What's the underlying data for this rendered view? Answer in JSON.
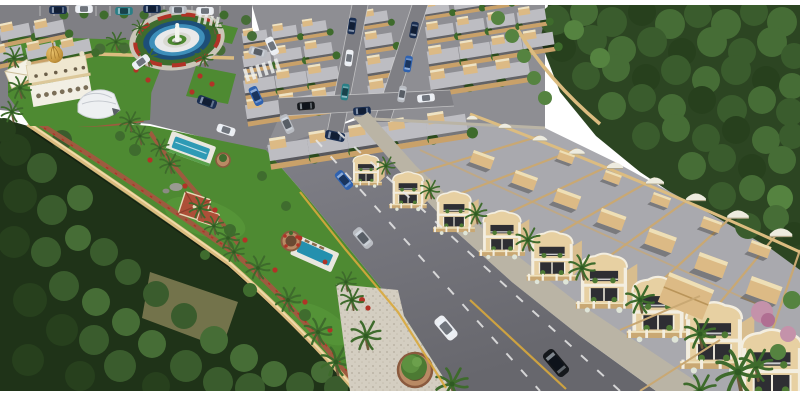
{
  "image": {
    "domain": "natural-image",
    "description": "Aerial 3D architectural rendering of a gated residential township: dense rows of flat-roof villas, a row of two-storey arched townhouses along a main boulevard, a landscaped central park with swimming pools and a red-roof gazebo, a fountain roundabout, a white clubhouse with a golden dome, a white event canopy, palm-lined sidewalks, cars on the roads, and dense forest framing the top-right and bottom-left.",
    "frame": {
      "background": "#ffffff",
      "top_margin_px": 5,
      "bottom_margin_px": 9
    }
  },
  "palette": {
    "white": "#ffffff",
    "plazaRoad": "#7f7f84",
    "asphaltTop": "#808088",
    "asphaltBot": "#66666d",
    "gridBase": "#8e8e93",
    "gridRoof": "#bdbdc2",
    "gridTan": "#dcba85",
    "gridWall": "#c9a169",
    "lawn": "#4e8a32",
    "lawnLight": "#5fa03e",
    "forest": "#2c4522",
    "forestDark": "#1f3318",
    "crown1": "#3a5c2d",
    "crown2": "#466d36",
    "crown3": "#27401d",
    "crownLight": "#558340",
    "clearing": "#7b7850",
    "paver": "#d4cec1",
    "sidewalk": "#bab4a5",
    "wallTan": "#dcbc80",
    "wallLight": "#f0dcab",
    "brick": "#9d5b3f",
    "flowerRed": "#b13327",
    "hedge": "#3f6c2e",
    "blueOuter": "#1d4f78",
    "blueInner": "#3e8fba",
    "ringWhite": "#e9e9ea",
    "padGray": "#d9d9d2",
    "statue": "#f4f4ee",
    "gold": "#c6973f",
    "mosqueWhite": "#f2efe4",
    "mosqueCream": "#efe7cf",
    "mosqueTrim": "#dcc89a",
    "gazeboRoof": "#ad4f38",
    "poolDeck": "#e9e7df",
    "poolWater": "#2e9ab5",
    "poolWater2": "#2490ae",
    "thFacade": "#e7d0a2",
    "thTrim": "#f3eee0",
    "thDark": "#2e2e33",
    "thRoof": "#a9a9ae",
    "thParapet": "#c9a873",
    "thSide": "#d8bd8e",
    "capWhite": "#edebdf",
    "palmGreen": "#3e6b2c",
    "palmTrunk": "#6e5a3a",
    "pinkTree": "#c492aa",
    "yellowLine": "#d8a93c",
    "carNavy": "#1b2f52",
    "carBlue": "#2f62b0",
    "carSilver": "#b9bcc2",
    "carWhite": "#eceef2",
    "carBlack": "#15181c",
    "carTeal": "#2a7f86"
  },
  "scene": {
    "regions": [
      {
        "name": "entry-plaza",
        "description": "asphalt entry plaza with fountain roundabout, white parking ticks, parked cars, zebra crosswalk"
      },
      {
        "name": "fountain-roundabout",
        "rings": [
          "red flower hedge ring",
          "dark blue water ring",
          "light blue water ring",
          "white walkway ring",
          "central lawn pad with white statue"
        ],
        "palms": 4
      },
      {
        "name": "mosque-clubhouse",
        "features": [
          "white arched two-storey facade",
          "golden onion dome with finial",
          "gabled side wing"
        ]
      },
      {
        "name": "event-canopy",
        "description": "white curved fabric canopy on the clubhouse lawn"
      },
      {
        "name": "villa-grid",
        "rows": 5,
        "approx_units": 37,
        "unit_style": "flat grey roof slab, tan rooftop room, beige front wall, street tree between units",
        "internal_streets": 3
      },
      {
        "name": "townhouse-row",
        "units": 10,
        "style": "two-storey cream facades with curved white-trimmed parapets, dark recessed balconies with shrubs, tan boundary fences, grey roofs with tan parapet walls, tan stair boxes and white arched roof caps at the rear"
      },
      {
        "name": "main-road",
        "lanes": 3,
        "markings": [
          "white dashed lane lines",
          "yellow edge lines"
        ],
        "vehicles_driving": 4
      },
      {
        "name": "central-park",
        "features": [
          "curved tan boundary wall",
          "brick walking paths lined with red flowers",
          "two blue swimming pools with white decks",
          "red-roof gazebo and hut",
          "round stone flower planter",
          "grey rocks",
          "palm trees",
          "lawn"
        ]
      },
      {
        "name": "paver-plaza",
        "features": [
          "light stone paving",
          "circular brick tree planter",
          "palm trees"
        ]
      },
      {
        "name": "forest",
        "coverage": [
          "top-right block",
          "bottom-left block with olive clearing"
        ]
      },
      {
        "name": "corner-block",
        "features": [
          "large grey roofs",
          "tan gabled roof structure",
          "pink flowering trees",
          "tall palms"
        ]
      }
    ],
    "vehicles": {
      "total_visible": 24,
      "driving_on_main_road": [
        "blue sedan",
        "silver sedan",
        "white sedan",
        "black suv"
      ],
      "parked_colors": [
        "navy",
        "white",
        "teal",
        "silver",
        "blue",
        "black"
      ]
    }
  }
}
